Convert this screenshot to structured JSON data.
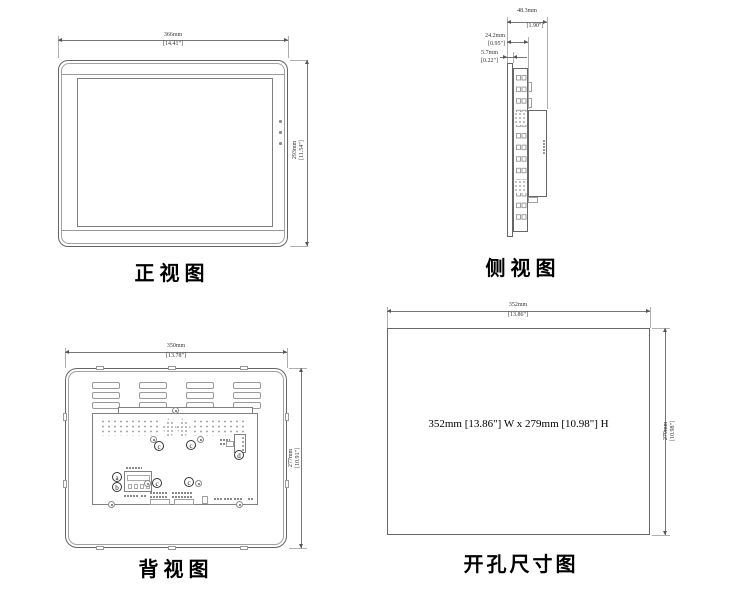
{
  "drawing": {
    "views": {
      "front": {
        "title": "正视图",
        "width_mm": "366mm",
        "width_in": "[14.41\"]",
        "height_mm": "293mm",
        "height_in": "[11.54\"]"
      },
      "side": {
        "title": "侧视图",
        "depth_total_mm": "48.3mm",
        "depth_total_in": "[1.90\"]",
        "depth_body_mm": "24.2mm",
        "depth_body_in": "[0.95\"]",
        "depth_bezel_mm": "5.7mm",
        "depth_bezel_in": "[0.22\"]"
      },
      "back": {
        "title": "背视图",
        "width_mm": "350mm",
        "width_in": "[13.78\"]",
        "height_mm": "277mm",
        "height_in": "[10.91\"]",
        "callouts": [
          "a",
          "b",
          "c",
          "c",
          "c",
          "c",
          "d"
        ]
      },
      "cutout": {
        "title": "开孔尺寸图",
        "width_mm": "352mm",
        "width_in": "[13.86\"]",
        "height_mm": "279mm",
        "height_in": "[10.98\"]",
        "note": "352mm [13.86\"] W x 279mm [10.98\"] H"
      }
    },
    "colors": {
      "line": "#666666",
      "dim_line": "#777777",
      "text": "#222222",
      "background": "#ffffff"
    }
  }
}
